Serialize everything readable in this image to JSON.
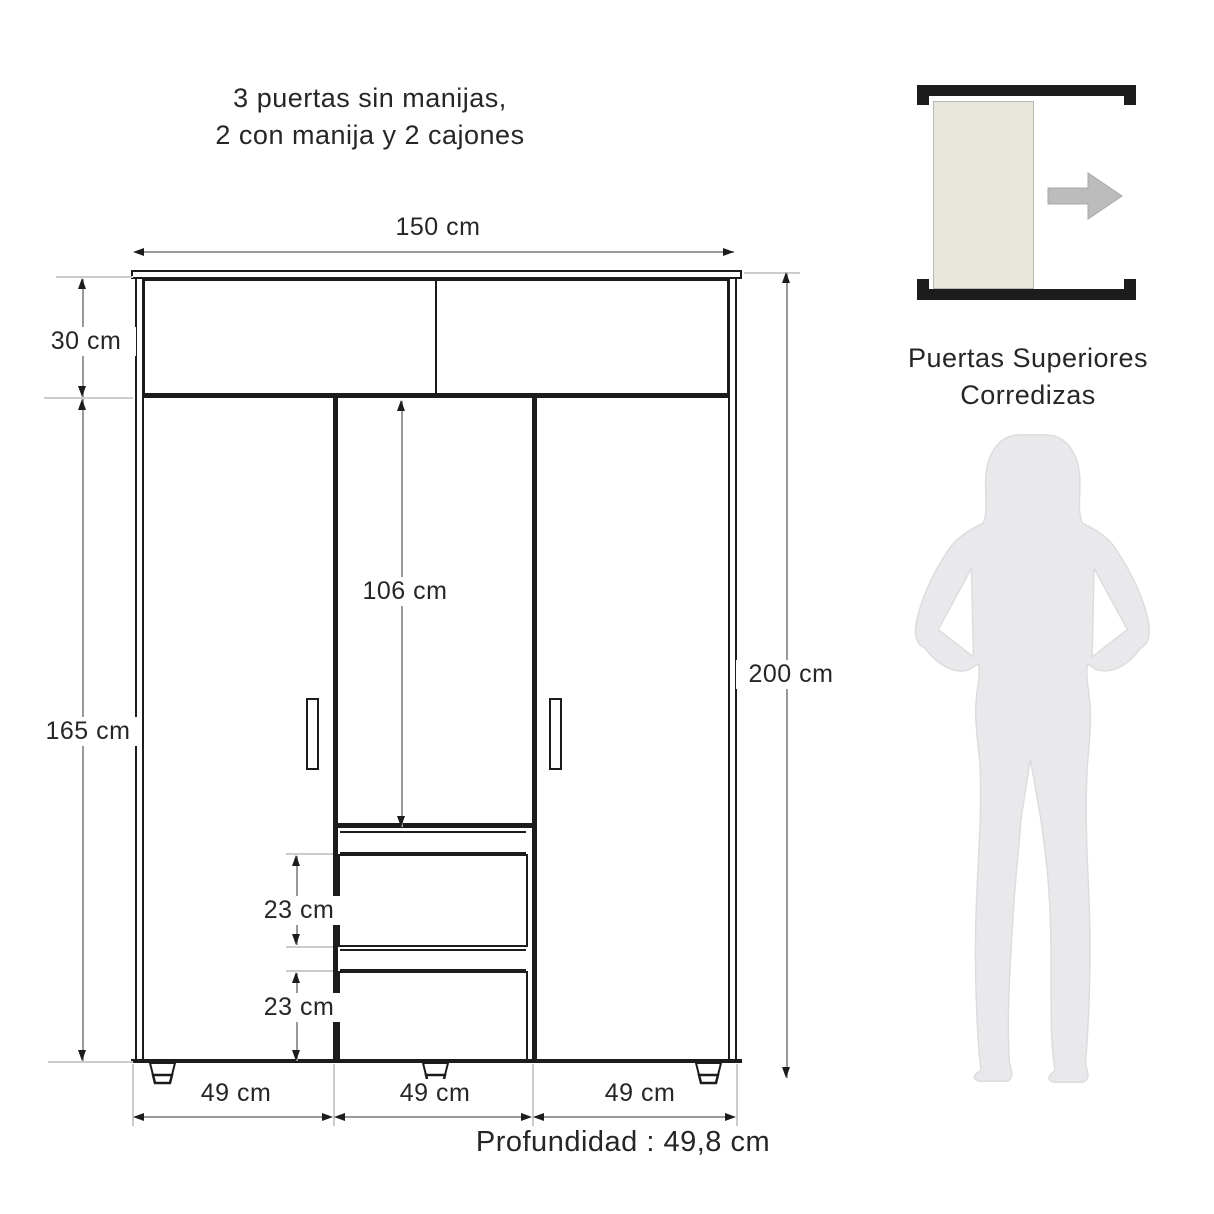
{
  "title": {
    "line1": "3 puertas sin manijas,",
    "line2": "2  con manija y 2 cajones"
  },
  "wardrobe": {
    "width_label": "150 cm",
    "top_section_label": "30 cm",
    "lower_section_label": "165 cm",
    "center_door_label": "106 cm",
    "total_height_label": "200 cm",
    "drawer_upper_label": "23 cm",
    "drawer_lower_label": "23 cm",
    "left_door_width_label": "49 cm",
    "center_door_width_label": "49 cm",
    "right_door_width_label": "49 cm",
    "depth_label": "Profundidad : 49,8 cm"
  },
  "legend": {
    "line1": "Puertas Superiores",
    "line2": "Corredizas"
  },
  "colors": {
    "outline": "#1c1c1c",
    "dimension_line": "#9a9a9a",
    "extension_line": "#cccccc",
    "sliding_door_fill": "#e8e7db",
    "direction_arrow": "#bcbcbc",
    "silhouette_fill": "#e9e9ec",
    "text": "#262626"
  }
}
